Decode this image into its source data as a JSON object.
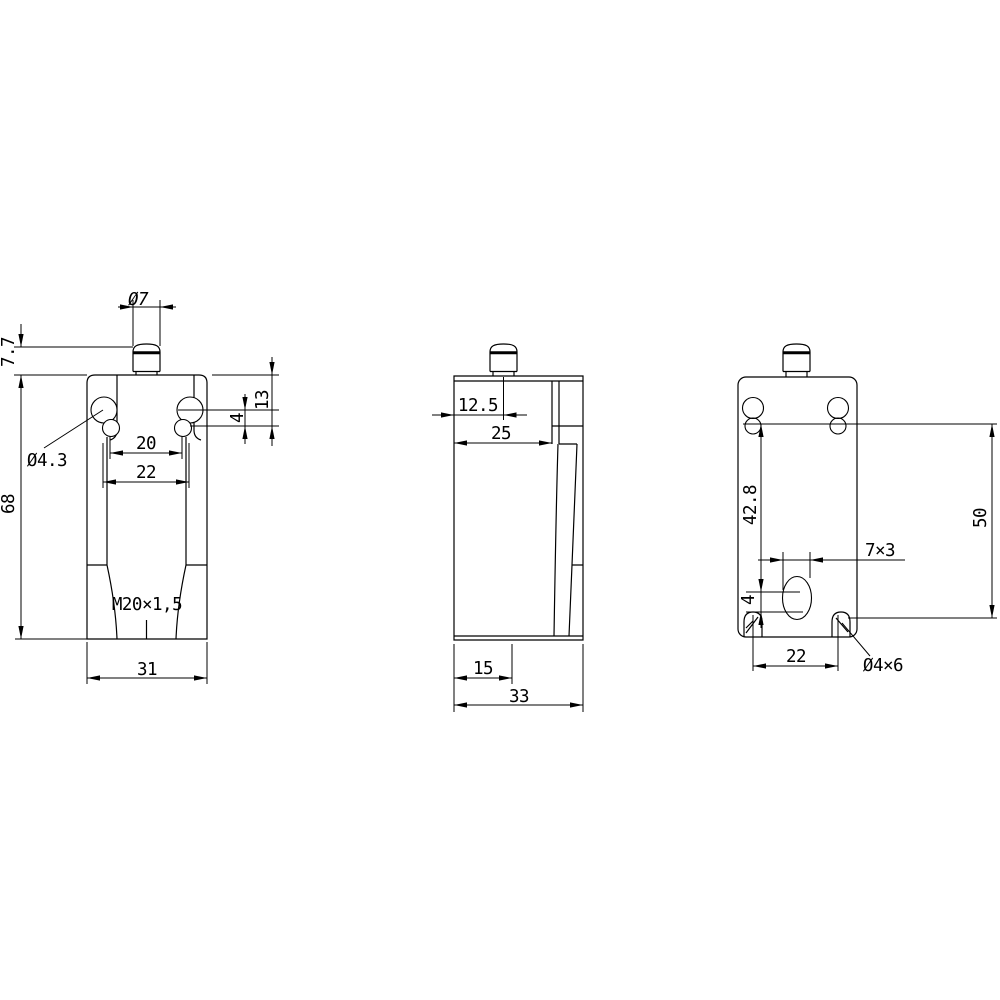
{
  "drawing": {
    "kind": "technical-dimension-drawing",
    "line_color": "#000000",
    "background_color": "#ffffff",
    "views": {
      "front": {
        "label": "front-view",
        "dims": {
          "plunger_diameter": "Ø7",
          "plunger_travel": "7.7",
          "slot_depth": "13",
          "slot_offset": "4",
          "inner_span": "20",
          "outer_span": "22",
          "mount_hole_diameter": "Ø4.3",
          "body_height": "68",
          "conduit_thread": "M20×1,5",
          "body_width": "31"
        }
      },
      "side": {
        "label": "side-view",
        "dims": {
          "plunger_axis_offset": "12.5",
          "head_depth": "25",
          "conduit_axis_offset": "15",
          "body_depth": "33"
        }
      },
      "back": {
        "label": "back-view",
        "dims": {
          "wire_hole_depth": "42.8",
          "mount_hole_vertical_span": "50",
          "wire_slot_size": "7×3",
          "wire_slot_offset": "4",
          "mount_hole_horizontal_span": "22",
          "corner_slot_size": "Ø4×6"
        }
      }
    }
  }
}
